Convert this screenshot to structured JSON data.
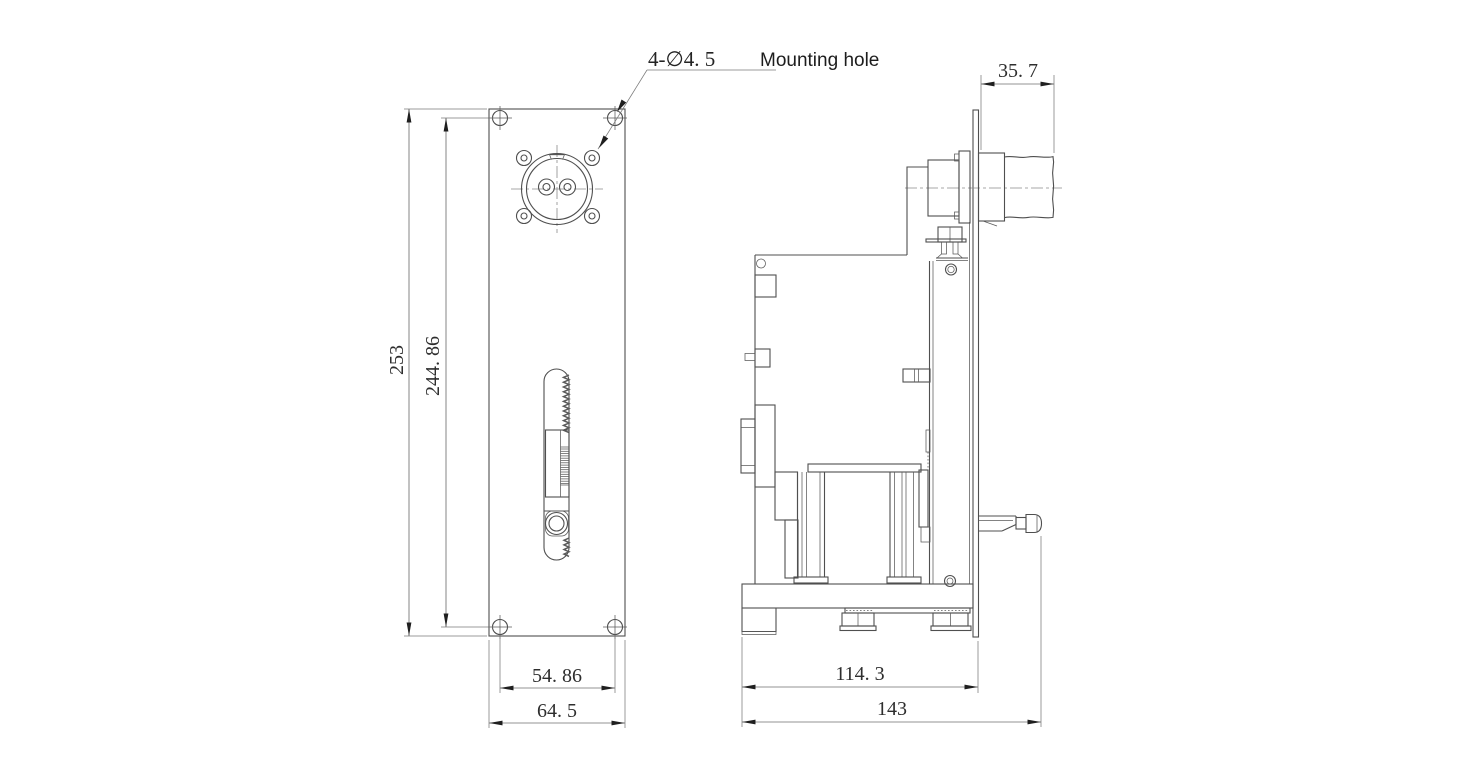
{
  "note": {
    "prefix": "4-∅4. 5",
    "suffix": "Mounting hole"
  },
  "front_view": {
    "dim_height_overall": "253",
    "dim_hole_span_vertical": "244. 86",
    "dim_hole_span_horizontal": "54. 86",
    "dim_width_overall": "64. 5"
  },
  "side_view": {
    "dim_roller_length": "35. 7",
    "dim_body_depth": "114. 3",
    "dim_overall_depth": "143"
  },
  "colors": {
    "line": "#4f4f4f",
    "dimension_line": "#6f6f6f",
    "text": "#2e2e2e",
    "arrow": "#1f1f1f",
    "background": "#ffffff"
  }
}
